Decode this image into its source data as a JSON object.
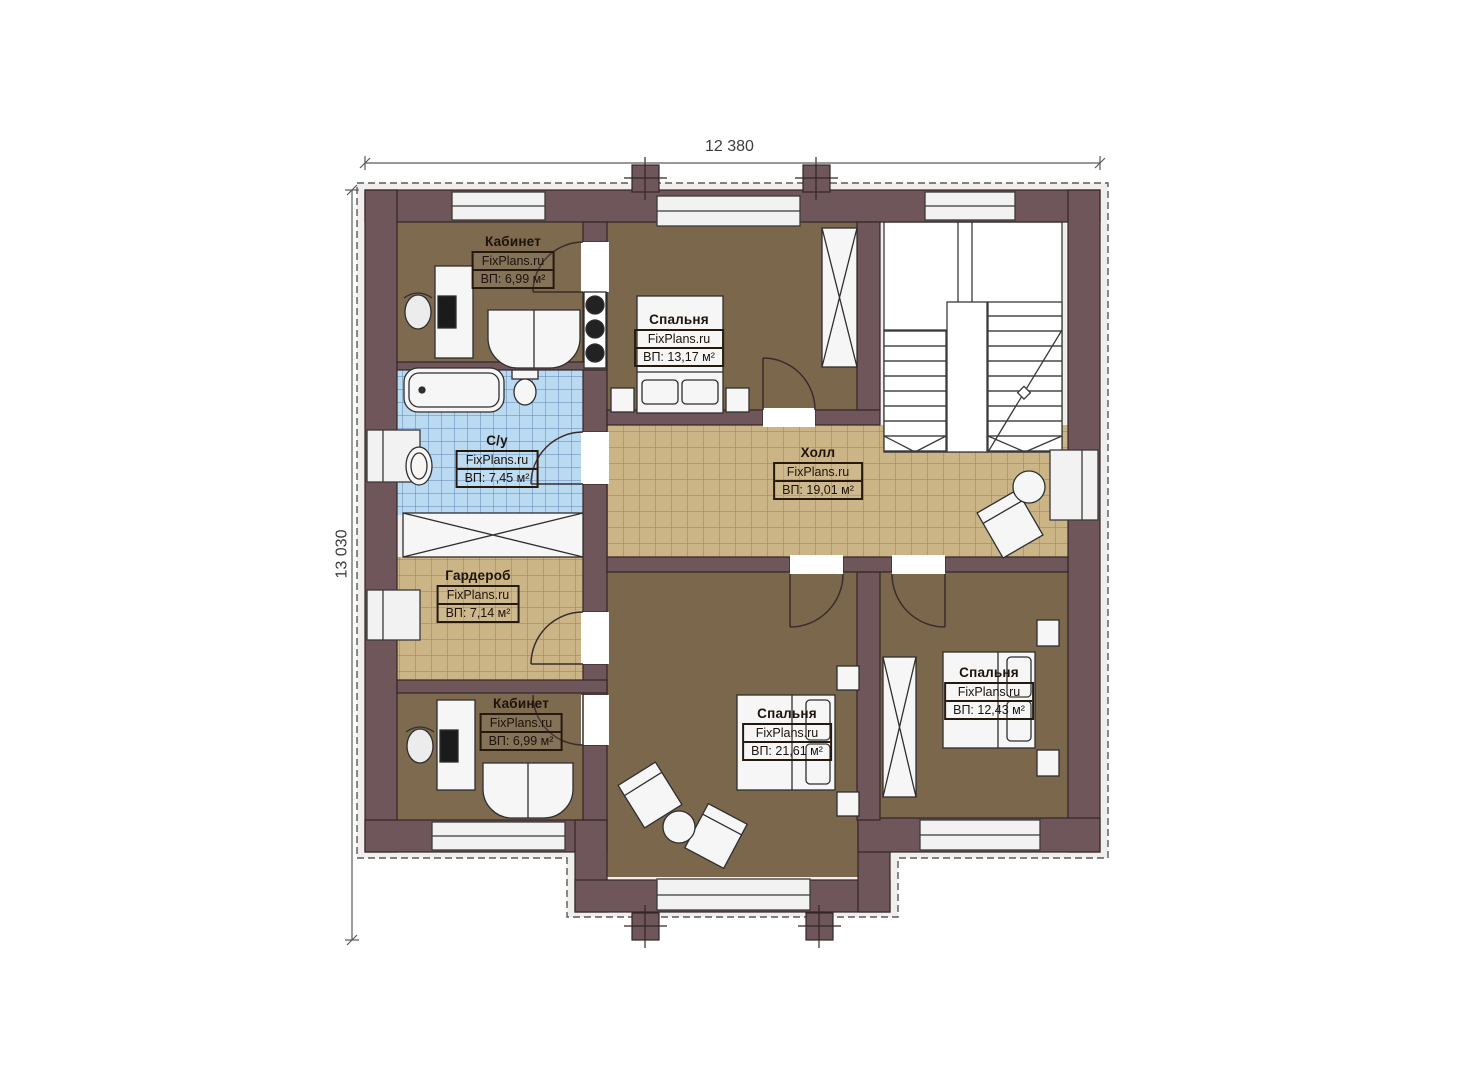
{
  "dimensions": {
    "width": "12 380",
    "height": "13 030"
  },
  "rooms": [
    {
      "name": "Кабинет",
      "watermark": "FixPlans.ru",
      "area": "ВП: 6,99 м²"
    },
    {
      "name": "Спальня",
      "watermark": "FixPlans.ru",
      "area": "ВП: 13,17 м²"
    },
    {
      "name": "С/у",
      "watermark": "FixPlans.ru",
      "area": "ВП: 7,45 м²"
    },
    {
      "name": "Холл",
      "watermark": "FixPlans.ru",
      "area": "ВП: 19,01 м²"
    },
    {
      "name": "Гардероб",
      "watermark": "FixPlans.ru",
      "area": "ВП: 7,14 м²"
    },
    {
      "name": "Кабинет",
      "watermark": "FixPlans.ru",
      "area": "ВП: 6,99 м²"
    },
    {
      "name": "Спальня",
      "watermark": "FixPlans.ru",
      "area": "ВП: 21,61 м²"
    },
    {
      "name": "Спальня",
      "watermark": "FixPlans.ru",
      "area": "ВП: 12,43 м²"
    }
  ],
  "colors": {
    "wall": "#6e565a",
    "floor_brown": "#7d6a4f",
    "tile_beige": "#cbb486",
    "tile_blue": "#badaf2",
    "furniture": "#f6f6f6",
    "outline": "#332626"
  }
}
